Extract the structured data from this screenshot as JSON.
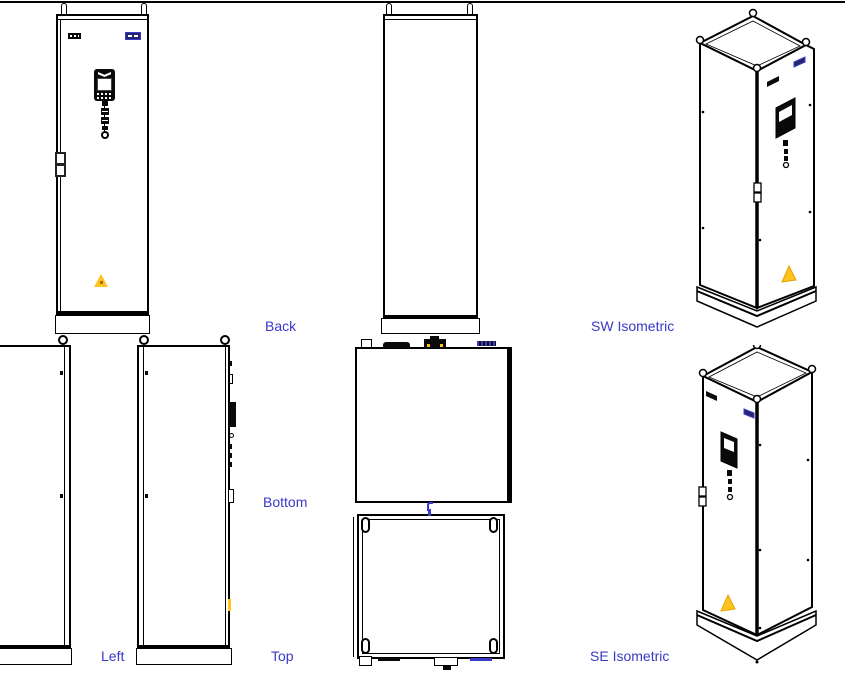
{
  "sheet": {
    "type": "cad-multiview-drawing",
    "view_count_visible": 7
  },
  "view_labels": {
    "back": "Back",
    "bottom": "Bottom",
    "top": "Top",
    "left": "Left",
    "sw_isometric": "SW Isometric",
    "se_isometric": "SE Isometric"
  },
  "colors": {
    "background": "#ffffff",
    "line": "#000000",
    "label-text": "#3939c8",
    "accent-blue": "#3939c8",
    "warning-fill": "#ffc41e",
    "warning-outline": "#e8a000"
  },
  "icons": {
    "lifting-eye-icon": "ring / eyebolt",
    "warning-triangle-icon": "▲",
    "hmi-display-icon": "▣",
    "vent-grille-icon": "▬ dotted",
    "nameplate-icon": "▭ dashed blue",
    "door-latch-icon": "▯▯ stacked",
    "center-mark-icon": "blue tick"
  }
}
